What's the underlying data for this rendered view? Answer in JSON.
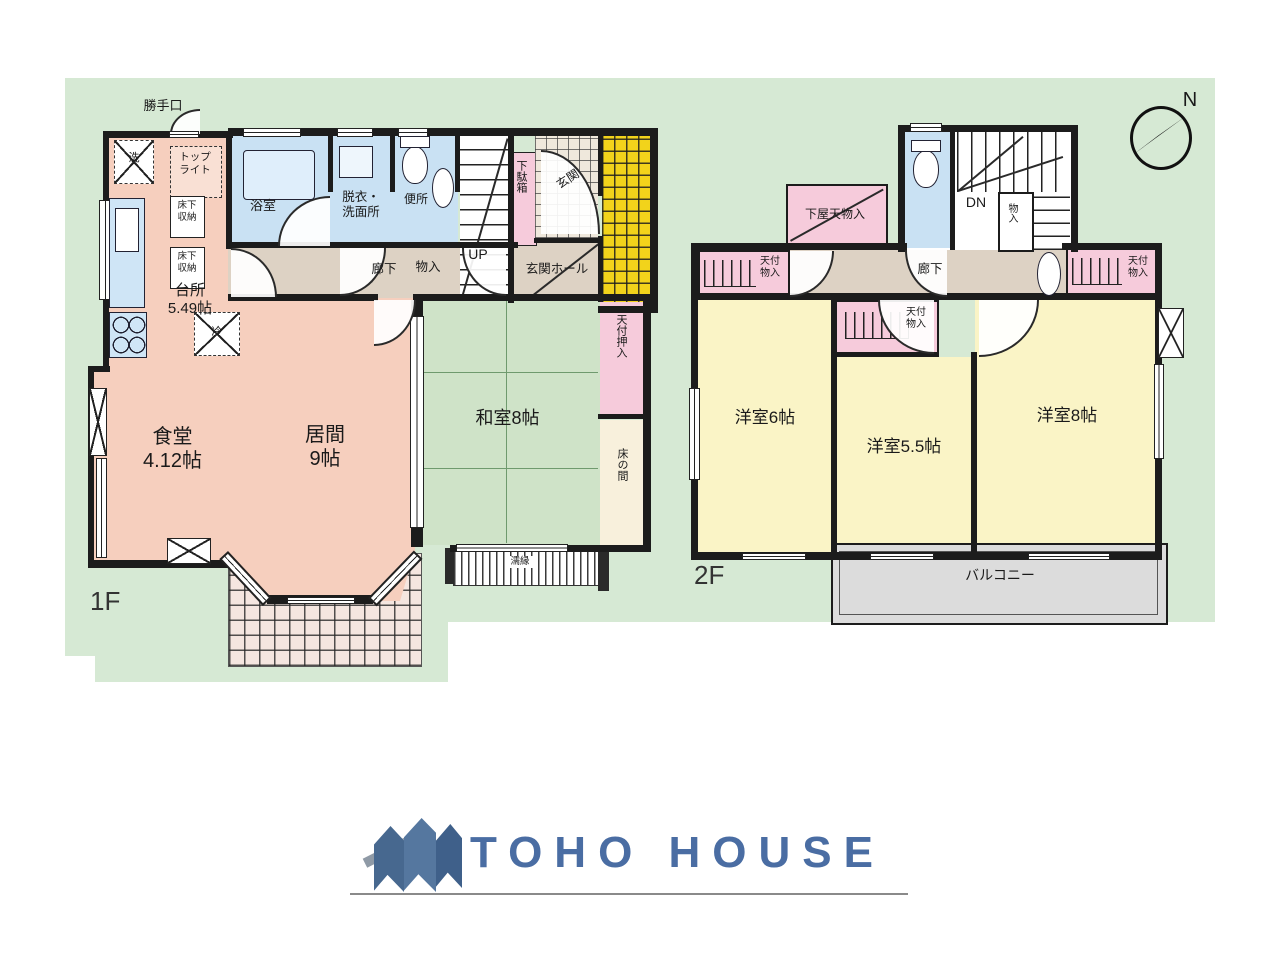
{
  "floor1": {
    "label": "1F",
    "kitchen": "台所\n5.49帖",
    "dining": "食堂\n4.12帖",
    "living": "居間\n9帖",
    "washitsu": "和室8帖",
    "bath": "浴室",
    "wash": "脱衣・\n洗面所",
    "wc": "便所",
    "genkan": "玄関",
    "getabako": "下駄箱",
    "hall": "玄関ホール",
    "corridor": "廊下",
    "storage": "物入",
    "up": "UP",
    "backdoor": "勝手口",
    "toplight": "トップ\nライト",
    "washer": "洗",
    "fridge": "冷",
    "floor_storage": "床下\n収納",
    "oshiire": "天付押入",
    "tokonoma": "床の間",
    "nureen": "濡縁"
  },
  "floor2": {
    "label": "2F",
    "room6": "洋室6帖",
    "room55": "洋室5.5帖",
    "room8": "洋室8帖",
    "balcony": "バルコニー",
    "corridor": "廊下",
    "dn": "DN",
    "storage": "物入",
    "closet": "天付\n物入",
    "shimoya": "下屋天物入"
  },
  "compass": {
    "north": "N"
  },
  "logo": {
    "brand": "TOHO HOUSE"
  },
  "colors": {
    "backdrop_green": "#d6e9d4",
    "room_pink": "#f6cfbe",
    "tatami_green": "#cfe3c8",
    "water_blue": "#c9e1f3",
    "closet_pink": "#f6cbdb",
    "yellow_room": "#faf4c6",
    "porch_yellow": "#f2d31b",
    "balcony_grey": "#dcdcdc",
    "corridor_beige": "#ddd2c4",
    "tokonoma_cream": "#f8f0dc",
    "logo_blue": "#4a6da3",
    "wall_black": "#1c1c1c"
  }
}
